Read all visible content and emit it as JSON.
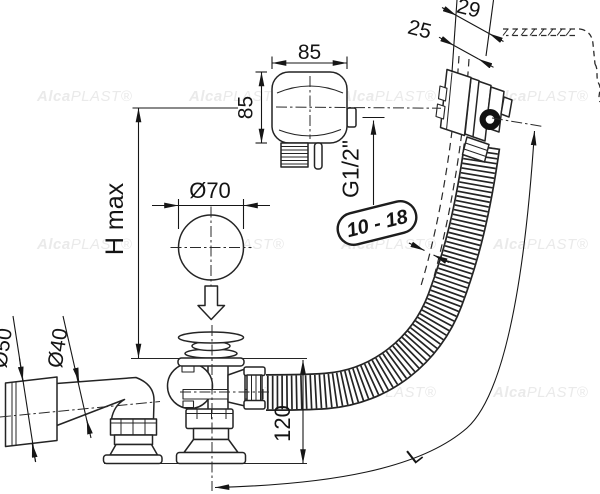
{
  "title": "Bath waste and overflow set - technical drawing",
  "labels": {
    "knob_width": "85",
    "knob_height": "85",
    "overflow_depth_total": "29",
    "overflow_depth_wall": "25",
    "thread_size": "G1/2\"",
    "wall_thickness_range": "10 - 18",
    "height_max": "H max",
    "stopper_diameter": "Ø70",
    "pipe_outer_diameter": "Ø50",
    "pipe_inner_diameter": "Ø40",
    "waste_height": "120",
    "hose_length": "L"
  },
  "watermark": {
    "brand_bold": "Alca",
    "brand_light": "PLAST®"
  },
  "colors": {
    "line": "#242424",
    "dimension": "#161616",
    "oring": "#111111",
    "watermark": "#eaeaea",
    "background": "#ffffff"
  }
}
